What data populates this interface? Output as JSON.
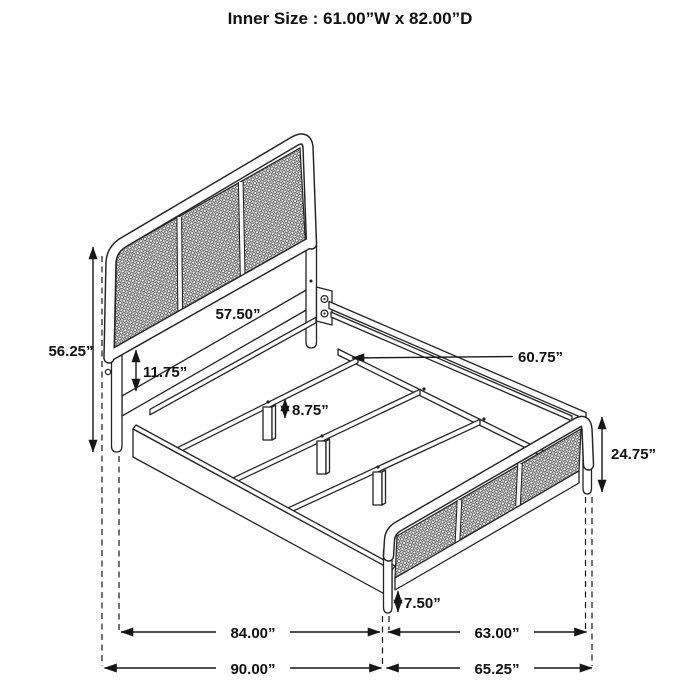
{
  "title": "Inner Size : 61.00”W x 82.00”D",
  "diagram": {
    "subject": "bed-frame-dimension-drawing",
    "dims": {
      "inner_size": "Inner Size : 61.00”W x 82.00”D",
      "headboard_panel_width": "57.50”",
      "headboard_height": "56.25”",
      "headboard_panel_drop": "11.75”",
      "side_rail_length": "60.75”",
      "center_leg_height": "8.75”",
      "footboard_height": "24.75”",
      "footboard_leg_height": "7.50”",
      "inner_length": "84.00”",
      "footboard_inner_width": "63.00”",
      "overall_length": "90.00”",
      "overall_width": "65.25”"
    },
    "colors": {
      "line": "#232323",
      "dimension": "#161616",
      "background": "#ffffff"
    }
  }
}
